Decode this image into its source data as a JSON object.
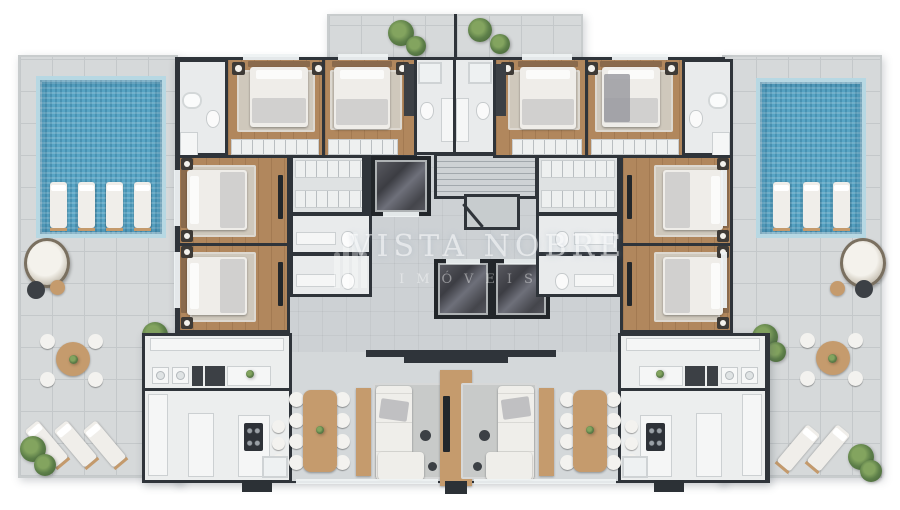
{
  "watermark": {
    "line1": "VISTA NOBRE",
    "line2": "IMÓVEIS"
  },
  "palette": {
    "wall": "#2f343a",
    "interior": "#cdd1d4",
    "interior-grid": "rgba(0,0,0,0.04)",
    "deck": "#d6d9da",
    "deck-line": "#c4c8ca",
    "pool": "#58a5c5",
    "pool-tile": "#b7d8e3",
    "wood": "#b1875d",
    "room-white": "#e9ebec",
    "furn-wood": "#c59b6d",
    "furn-dark": "#3c4045",
    "canvas": "#ffffff"
  },
  "scene": {
    "description": "3D rendered residential floor plan: two mirrored apartments, central stair and elevator core, flanking roof terraces each with a mosaic-tiled pool",
    "pools": 2,
    "elevators": 3,
    "bedrooms_per_apartment": 4
  }
}
